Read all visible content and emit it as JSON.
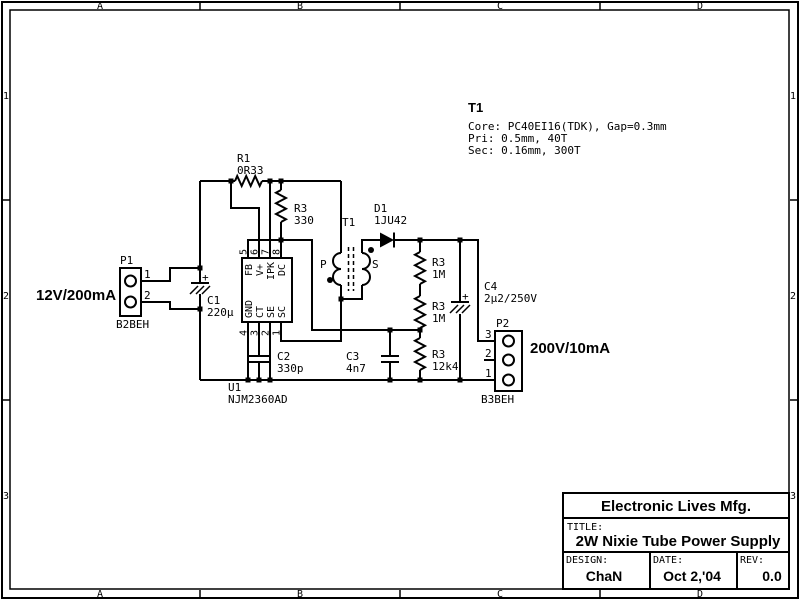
{
  "frame": {
    "cols": [
      "A",
      "B",
      "C",
      "D"
    ],
    "rows": [
      "1",
      "2",
      "3"
    ]
  },
  "input_connector": {
    "ref": "P1",
    "part": "B2BEH",
    "pins": [
      "1",
      "2"
    ],
    "rating": "12V/200mA"
  },
  "output_connector": {
    "ref": "P2",
    "part": "B3BEH",
    "pins": [
      "3",
      "2",
      "1"
    ],
    "rating": "200V/10mA"
  },
  "ic": {
    "ref": "U1",
    "part": "NJM2360AD",
    "top_pins": [
      {
        "num": "5",
        "name": "FB"
      },
      {
        "num": "6",
        "name": "V+"
      },
      {
        "num": "7",
        "name": "IPK"
      },
      {
        "num": "8",
        "name": "DC"
      }
    ],
    "bottom_pins": [
      {
        "num": "4",
        "name": "GND"
      },
      {
        "num": "3",
        "name": "CT"
      },
      {
        "num": "2",
        "name": "SE"
      },
      {
        "num": "1",
        "name": "SC"
      }
    ]
  },
  "resistors": {
    "r1": {
      "ref": "R1",
      "value": "0R33"
    },
    "r330": {
      "ref": "R3",
      "value": "330"
    },
    "r1m_a": {
      "ref": "R3",
      "value": "1M"
    },
    "r1m_b": {
      "ref": "R3",
      "value": "1M"
    },
    "r12k4": {
      "ref": "R3",
      "value": "12k4"
    }
  },
  "capacitors": {
    "c1": {
      "ref": "C1",
      "value": "220μ",
      "polarity": "+"
    },
    "c2": {
      "ref": "C2",
      "value": "330p"
    },
    "c3": {
      "ref": "C3",
      "value": "4n7"
    },
    "c4": {
      "ref": "C4",
      "value": "2μ2/250V",
      "polarity": "+"
    }
  },
  "diode": {
    "ref": "D1",
    "value": "1JU42"
  },
  "transformer": {
    "ref": "T1",
    "primary_label": "P",
    "secondary_label": "S",
    "note_title": "T1",
    "note_lines": [
      "Core: PC40EI16(TDK), Gap=0.3mm",
      "Pri: 0.5mm, 40T",
      "Sec: 0.16mm, 300T"
    ]
  },
  "title_block": {
    "company": "Electronic Lives Mfg.",
    "title_label": "TITLE:",
    "title": "2W Nixie Tube Power Supply",
    "design_label": "DESIGN:",
    "designer": "ChaN",
    "date_label": "DATE:",
    "date": "Oct 2,'04",
    "rev_label": "REV:",
    "rev": "0.0"
  },
  "colors": {
    "ink": "#000000",
    "paper": "#ffffff"
  }
}
